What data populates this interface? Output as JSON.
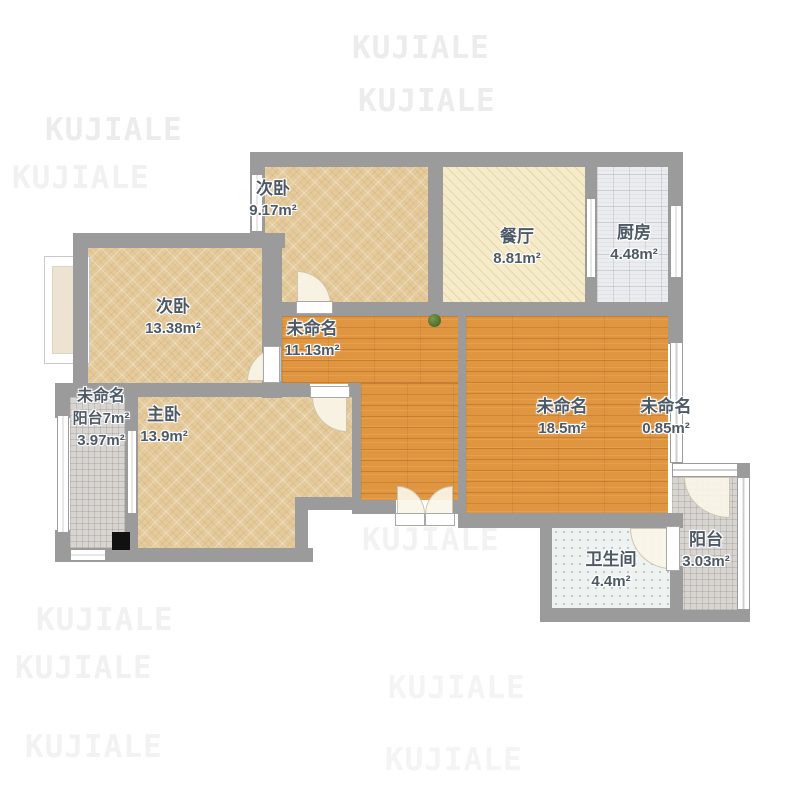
{
  "watermark": {
    "text": "KUJIALE"
  },
  "rooms": {
    "bedroom_top": {
      "name": "次卧",
      "area": "9.17m²"
    },
    "dining": {
      "name": "餐厅",
      "area": "8.81m²"
    },
    "kitchen": {
      "name": "厨房",
      "area": "4.48m²"
    },
    "bedroom_left": {
      "name": "次卧",
      "area": "13.38m²"
    },
    "hallway": {
      "name": "未命名",
      "area": "11.13m²"
    },
    "living": {
      "name": "未命名",
      "area": "18.5m²"
    },
    "side_strip": {
      "name": "未命名",
      "area": "0.85m²"
    },
    "balcony_left": {
      "name": "未命名",
      "label2": "阳台7m²",
      "area": "3.97m²"
    },
    "master": {
      "name": "主卧",
      "area": "13.9m²"
    },
    "bathroom": {
      "name": "卫生间",
      "area": "4.4m²"
    },
    "balcony_right": {
      "name": "阳台",
      "area": "3.03m²"
    }
  },
  "colors": {
    "wall": "#9b9b9b",
    "floor_wood": "#e09540",
    "floor_tan": "#e5ca9b",
    "floor_cream": "#f6ebc8",
    "floor_tile": "#ebecef",
    "floor_bath": "#eef3f1",
    "floor_balcony": "#d8d5d1",
    "label_text": "#4d5964",
    "watermark": "#ececec"
  }
}
